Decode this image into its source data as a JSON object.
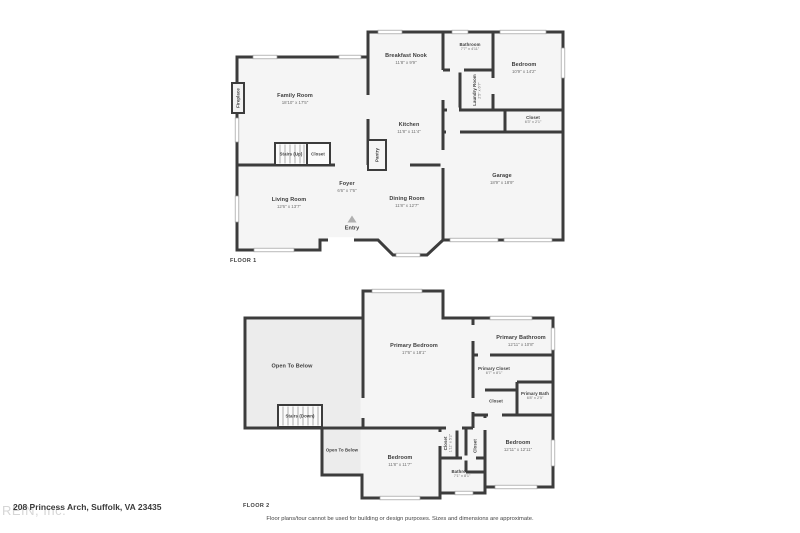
{
  "palette": {
    "wall": "#3c3c3c",
    "room_fill": "#f5f5f5",
    "open_below_fill": "#ececec",
    "window_fill": "#ffffff",
    "text": "#3d3d3d"
  },
  "floor1": {
    "label": "FLOOR 1",
    "rooms": {
      "family_room": {
        "name": "Family Room",
        "dims": "18'10\" x 17'5\""
      },
      "breakfast_nook": {
        "name": "Breakfast Nook",
        "dims": "11'8\" x 9'9\""
      },
      "bathroom": {
        "name": "Bathroom",
        "dims": "7'7\" x 4'11\""
      },
      "bedroom": {
        "name": "Bedroom",
        "dims": "10'9\" x 14'2\""
      },
      "laundry": {
        "name": "Laundry Room",
        "dims": "2'5\" x 6'7\""
      },
      "closet_bedroom": {
        "name": "Closet",
        "dims": "6'3\" x 2'1\""
      },
      "kitchen": {
        "name": "Kitchen",
        "dims": "11'8\" x 11'4\""
      },
      "fireplace": {
        "name": "Fireplace"
      },
      "stairs": {
        "name": "Stairs (Up)"
      },
      "closet_stairs": {
        "name": "Closet"
      },
      "pantry": {
        "name": "Pantry"
      },
      "foyer": {
        "name": "Foyer",
        "dims": "6'6\" x 7'6\""
      },
      "living_room": {
        "name": "Living Room",
        "dims": "12'6\" x 13'7\""
      },
      "dining_room": {
        "name": "Dining Room",
        "dims": "11'8\" x 12'7\""
      },
      "entry": {
        "name": "Entry"
      },
      "garage": {
        "name": "Garage",
        "dims": "18'9\" x 18'9\""
      }
    }
  },
  "floor2": {
    "label": "FLOOR 2",
    "rooms": {
      "open_below_large": {
        "name": "Open To Below"
      },
      "primary_bedroom": {
        "name": "Primary Bedroom",
        "dims": "17'6\" x 18'1\""
      },
      "primary_bathroom": {
        "name": "Primary Bathroom",
        "dims": "12'11\" x 10'8\""
      },
      "primary_closet": {
        "name": "Primary Closet",
        "dims": "6'7\" x 8'1\""
      },
      "closet_hall": {
        "name": "Closet"
      },
      "primary_bath": {
        "name": "Primary Bath",
        "dims": "6'8\" x 2'5\""
      },
      "stairs": {
        "name": "Stairs (Down)"
      },
      "open_below_small": {
        "name": "Open To Below"
      },
      "bedroom_left": {
        "name": "Bedroom",
        "dims": "11'8\" x 11'7\""
      },
      "closet_left": {
        "name": "Closet",
        "dims": "1'11\" x 5'2\""
      },
      "closet_right": {
        "name": "Closet"
      },
      "bathroom": {
        "name": "Bathroom",
        "dims": "7'1\" x 8'1\""
      },
      "bedroom_right": {
        "name": "Bedroom",
        "dims": "12'11\" x 12'11\""
      }
    }
  },
  "footer": {
    "address": "208 Princess Arch, Suffolk, VA 23435",
    "watermark": "REIN, Inc.",
    "disclaimer": "Floor plans/tour cannot be used for building or design purposes. Sizes and dimensions are approximate."
  }
}
